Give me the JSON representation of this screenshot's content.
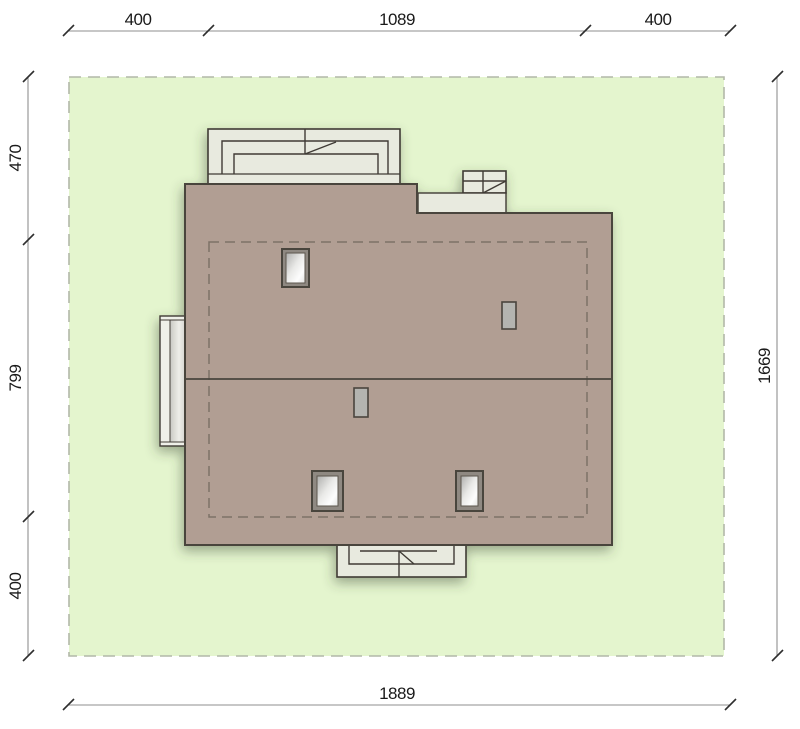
{
  "page": {
    "title": "Site plan with house roof view and plot dimensions"
  },
  "colors": {
    "background": "#ffffff",
    "plot_fill": "#e4f5ce",
    "plot_border": "#b2b8a8",
    "roof_fill": "#b19e93",
    "outline": "#4a443e",
    "structure_fill": "#e8eadf",
    "structure_stroke": "#3f3b35",
    "glass_frame": "#8f8982",
    "vent_fill": "#b4b4b0",
    "dashed_outline": "#7d7268",
    "dim_line": "#8f8f8f",
    "tick_color": "#2e2e2e",
    "dim_text": "#1a1a1a"
  },
  "dimensions": {
    "top": [
      "400",
      "1089",
      "400"
    ],
    "left": [
      "470",
      "799",
      "400"
    ],
    "right": [
      "1669"
    ],
    "bottom": [
      "1889"
    ]
  }
}
